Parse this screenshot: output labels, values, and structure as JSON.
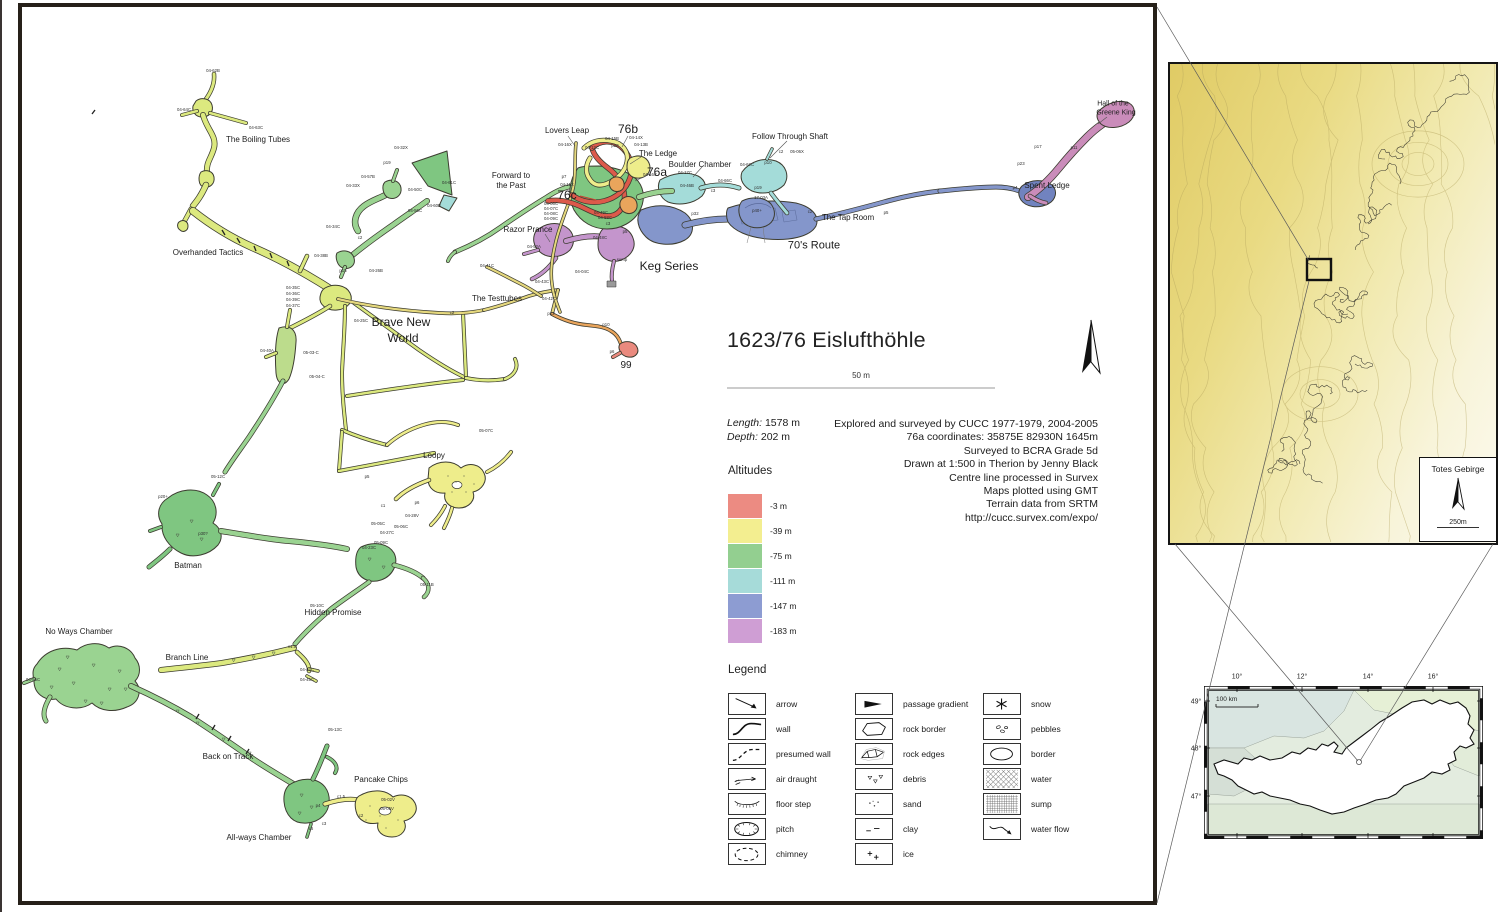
{
  "title_block": {
    "cave_number_title": "1623/76 Eislufthöhle",
    "scale_label": "50 m",
    "length_label": "Length:",
    "length_value": "1578 m",
    "depth_label": "Depth:",
    "depth_value": "202 m",
    "credits": [
      "Explored and surveyed by CUCC 1977-1979, 2004-2005",
      "76a coordinates: 35875E 82930N 1645m",
      "Surveyed to BCRA Grade 5d",
      "Drawn at 1:500 in Therion by Jenny Black",
      "Centre line processed in Survex",
      "Maps plotted using GMT",
      "Terrain data from SRTM",
      "http://cucc.survex.com/expo/"
    ]
  },
  "altitudes": {
    "heading": "Altitudes",
    "items": [
      {
        "label": "-3 m",
        "color": "#ec8b82"
      },
      {
        "label": "-39 m",
        "color": "#f3ee90"
      },
      {
        "label": "-75 m",
        "color": "#93cf90"
      },
      {
        "label": "-111 m",
        "color": "#a6dbd9"
      },
      {
        "label": "-147 m",
        "color": "#8d9cd2"
      },
      {
        "label": "-183 m",
        "color": "#cf9ed4"
      }
    ]
  },
  "legend": {
    "heading": "Legend",
    "columns": [
      [
        {
          "symbol": "arrow",
          "label": "arrow"
        },
        {
          "symbol": "wall",
          "label": "wall"
        },
        {
          "symbol": "presumed-wall",
          "label": "presumed wall"
        },
        {
          "symbol": "air-draught",
          "label": "air draught"
        },
        {
          "symbol": "floor-step",
          "label": "floor step"
        },
        {
          "symbol": "pitch",
          "label": "pitch"
        },
        {
          "symbol": "chimney",
          "label": "chimney"
        }
      ],
      [
        {
          "symbol": "passage-gradient",
          "label": "passage gradient"
        },
        {
          "symbol": "rock-border",
          "label": "rock border"
        },
        {
          "symbol": "rock-edges",
          "label": "rock edges"
        },
        {
          "symbol": "debris",
          "label": "debris"
        },
        {
          "symbol": "sand",
          "label": "sand"
        },
        {
          "symbol": "clay",
          "label": "clay"
        },
        {
          "symbol": "ice",
          "label": "ice"
        }
      ],
      [
        {
          "symbol": "snow",
          "label": "snow"
        },
        {
          "symbol": "pebbles",
          "label": "pebbles"
        },
        {
          "symbol": "border",
          "label": "border"
        },
        {
          "symbol": "water",
          "label": "water"
        },
        {
          "symbol": "sump",
          "label": "sump"
        },
        {
          "symbol": "water-flow",
          "label": "water flow"
        }
      ]
    ]
  },
  "map_labels": {
    "chambers": [
      [
        258,
        140,
        "The Boiling Tubes"
      ],
      [
        208,
        253,
        "Overhanded Tactics"
      ],
      [
        401,
        322,
        "Brave New",
        12
      ],
      [
        403,
        338,
        "World",
        12
      ],
      [
        567,
        131,
        "Lovers Leap"
      ],
      [
        658,
        154,
        "The Ledge"
      ],
      [
        700,
        165,
        "Boulder Chamber"
      ],
      [
        790,
        137,
        "Follow Through Shaft"
      ],
      [
        1113,
        104,
        "Hall of the",
        7
      ],
      [
        1116,
        113,
        "Greene King",
        7
      ],
      [
        1047,
        186,
        "Spent Ledge"
      ],
      [
        848,
        218,
        "The Tap Room"
      ],
      [
        814,
        246,
        "70's Route",
        11
      ],
      [
        669,
        266,
        "Keg Series",
        12
      ],
      [
        528,
        230,
        "Razor Prance"
      ],
      [
        511,
        176,
        "Forward to"
      ],
      [
        511,
        186,
        "the Past"
      ],
      [
        497,
        299,
        "The Testtubes"
      ],
      [
        434,
        456,
        "Loopy"
      ],
      [
        188,
        566,
        "Batman"
      ],
      [
        333,
        613,
        "Hidden Promise"
      ],
      [
        79,
        632,
        "No Ways Chamber"
      ],
      [
        187,
        658,
        "Branch Line"
      ],
      [
        228,
        757,
        "Back on Track"
      ],
      [
        259,
        838,
        "All-ways Chamber"
      ],
      [
        381,
        780,
        "Pancake Chips"
      ]
    ],
    "entrances": [
      [
        628,
        129,
        "76b",
        12
      ],
      [
        657,
        172,
        "76a",
        12
      ],
      [
        567,
        195,
        "76c",
        12
      ],
      [
        626,
        366,
        "99",
        10
      ]
    ],
    "stations": [
      [
        213,
        71,
        "04-62B"
      ],
      [
        184,
        110,
        "04-64C"
      ],
      [
        256,
        128,
        "04-63C"
      ],
      [
        401,
        148,
        "04-32X"
      ],
      [
        387,
        163,
        "p19"
      ],
      [
        368,
        177,
        "04-57B"
      ],
      [
        353,
        186,
        "04-33X"
      ],
      [
        449,
        183,
        "04-61C"
      ],
      [
        415,
        190,
        "04-50C"
      ],
      [
        434,
        206,
        "04-60B"
      ],
      [
        415,
        211,
        "04-56C"
      ],
      [
        333,
        227,
        "04-34C"
      ],
      [
        360,
        238,
        "c2"
      ],
      [
        321,
        256,
        "04-38B"
      ],
      [
        343,
        271,
        "p15"
      ],
      [
        376,
        271,
        "04-26B"
      ],
      [
        293,
        288,
        "04-35C"
      ],
      [
        293,
        294,
        "04-36C"
      ],
      [
        293,
        300,
        "04-39C"
      ],
      [
        293,
        306,
        "04-37C"
      ],
      [
        361,
        321,
        "04-25C"
      ],
      [
        267,
        351,
        "04-40A"
      ],
      [
        311,
        353,
        "05-03-C"
      ],
      [
        317,
        377,
        "05-04-C"
      ],
      [
        565,
        145,
        "04-16X"
      ],
      [
        612,
        139,
        "04-15B"
      ],
      [
        615,
        146,
        "p20"
      ],
      [
        636,
        138,
        "04-14X"
      ],
      [
        641,
        145,
        "04-13B"
      ],
      [
        592,
        148,
        "04-12C"
      ],
      [
        564,
        177,
        "p7"
      ],
      [
        567,
        185,
        "04-11X"
      ],
      [
        650,
        175,
        "04-16C"
      ],
      [
        685,
        173,
        "04-17C"
      ],
      [
        687,
        186,
        "04-46B"
      ],
      [
        713,
        191,
        "c3"
      ],
      [
        725,
        181,
        "04-66C"
      ],
      [
        747,
        165,
        "04-62C"
      ],
      [
        768,
        163,
        "p10"
      ],
      [
        758,
        188,
        "p19"
      ],
      [
        781,
        152,
        "c2"
      ],
      [
        797,
        152,
        "05-06X"
      ],
      [
        695,
        214,
        "p32"
      ],
      [
        757,
        211,
        "p40+"
      ],
      [
        761,
        198,
        "17-03A"
      ],
      [
        810,
        212,
        "c2"
      ],
      [
        886,
        213,
        "p5"
      ],
      [
        1015,
        188,
        "p4"
      ],
      [
        1021,
        164,
        "p23"
      ],
      [
        1038,
        147,
        "p17"
      ],
      [
        1074,
        148,
        "p11"
      ],
      [
        551,
        204,
        "04-06C"
      ],
      [
        551,
        209,
        "04-07C"
      ],
      [
        551,
        214,
        "04-08C"
      ],
      [
        551,
        219,
        "04-09C"
      ],
      [
        601,
        213,
        "04-49C"
      ],
      [
        605,
        218,
        "04-58C"
      ],
      [
        608,
        224,
        "c3"
      ],
      [
        600,
        238,
        "04-48C"
      ],
      [
        625,
        232,
        "p5"
      ],
      [
        622,
        260,
        "sump"
      ],
      [
        534,
        247,
        "04-52A"
      ],
      [
        582,
        272,
        "04-04C"
      ],
      [
        542,
        282,
        "04-43C"
      ],
      [
        549,
        299,
        "04-42C"
      ],
      [
        487,
        266,
        "04-41C"
      ],
      [
        452,
        313,
        "c2"
      ],
      [
        551,
        314,
        "p12"
      ],
      [
        606,
        325,
        "p10"
      ],
      [
        612,
        352,
        "p6"
      ],
      [
        163,
        497,
        "p20+"
      ],
      [
        218,
        477,
        "05-12C"
      ],
      [
        203,
        534,
        "p30?"
      ],
      [
        367,
        477,
        "p5"
      ],
      [
        417,
        503,
        "p6"
      ],
      [
        412,
        516,
        "04-28V"
      ],
      [
        383,
        506,
        "c1"
      ],
      [
        378,
        524,
        "05-05C"
      ],
      [
        401,
        527,
        "05-06C"
      ],
      [
        387,
        533,
        "04-27C"
      ],
      [
        369,
        548,
        "04-23C"
      ],
      [
        381,
        543,
        "05-09C"
      ],
      [
        427,
        585,
        "05-11B"
      ],
      [
        486,
        431,
        "05-07C"
      ],
      [
        317,
        606,
        "05-10C"
      ],
      [
        292,
        647,
        "c1.5"
      ],
      [
        307,
        670,
        "04-44C"
      ],
      [
        307,
        680,
        "04-45C"
      ],
      [
        33,
        680,
        "04-56C"
      ],
      [
        335,
        730,
        "05-13C"
      ],
      [
        341,
        797,
        "c1.5"
      ],
      [
        388,
        800,
        "05-02V"
      ],
      [
        387,
        809,
        "05-01V"
      ],
      [
        318,
        806,
        "p4"
      ],
      [
        324,
        824,
        "c3"
      ],
      [
        311,
        829,
        "c6"
      ],
      [
        361,
        816,
        "c2"
      ]
    ]
  },
  "overview_inset": {
    "region_name": "Totes Gebirge",
    "scale_label": "250m",
    "cave_numbers": [
      [
        1424,
        170,
        "204"
      ],
      [
        1366,
        204,
        "234"
      ],
      [
        1248,
        258,
        "182"
      ],
      [
        1338,
        312,
        "145"
      ],
      [
        1431,
        321,
        "161"
      ],
      [
        1410,
        374,
        "40"
      ],
      [
        1302,
        469,
        "41"
      ]
    ]
  },
  "austria_inset": {
    "country_label": "AUSTRIA",
    "scale_label": "100 km",
    "lon_ticks": [
      "10°",
      "12°",
      "14°",
      "16°"
    ],
    "lat_ticks": [
      "49°",
      "48°",
      "47°"
    ],
    "cities": [
      {
        "label": "Salzburg",
        "x": 1308,
        "y": 751,
        "dot_x": 1334,
        "dot_y": 757
      },
      {
        "label": "Wien",
        "x": 1424,
        "y": 734,
        "dot_x": 1439,
        "dot_y": 737
      }
    ]
  }
}
